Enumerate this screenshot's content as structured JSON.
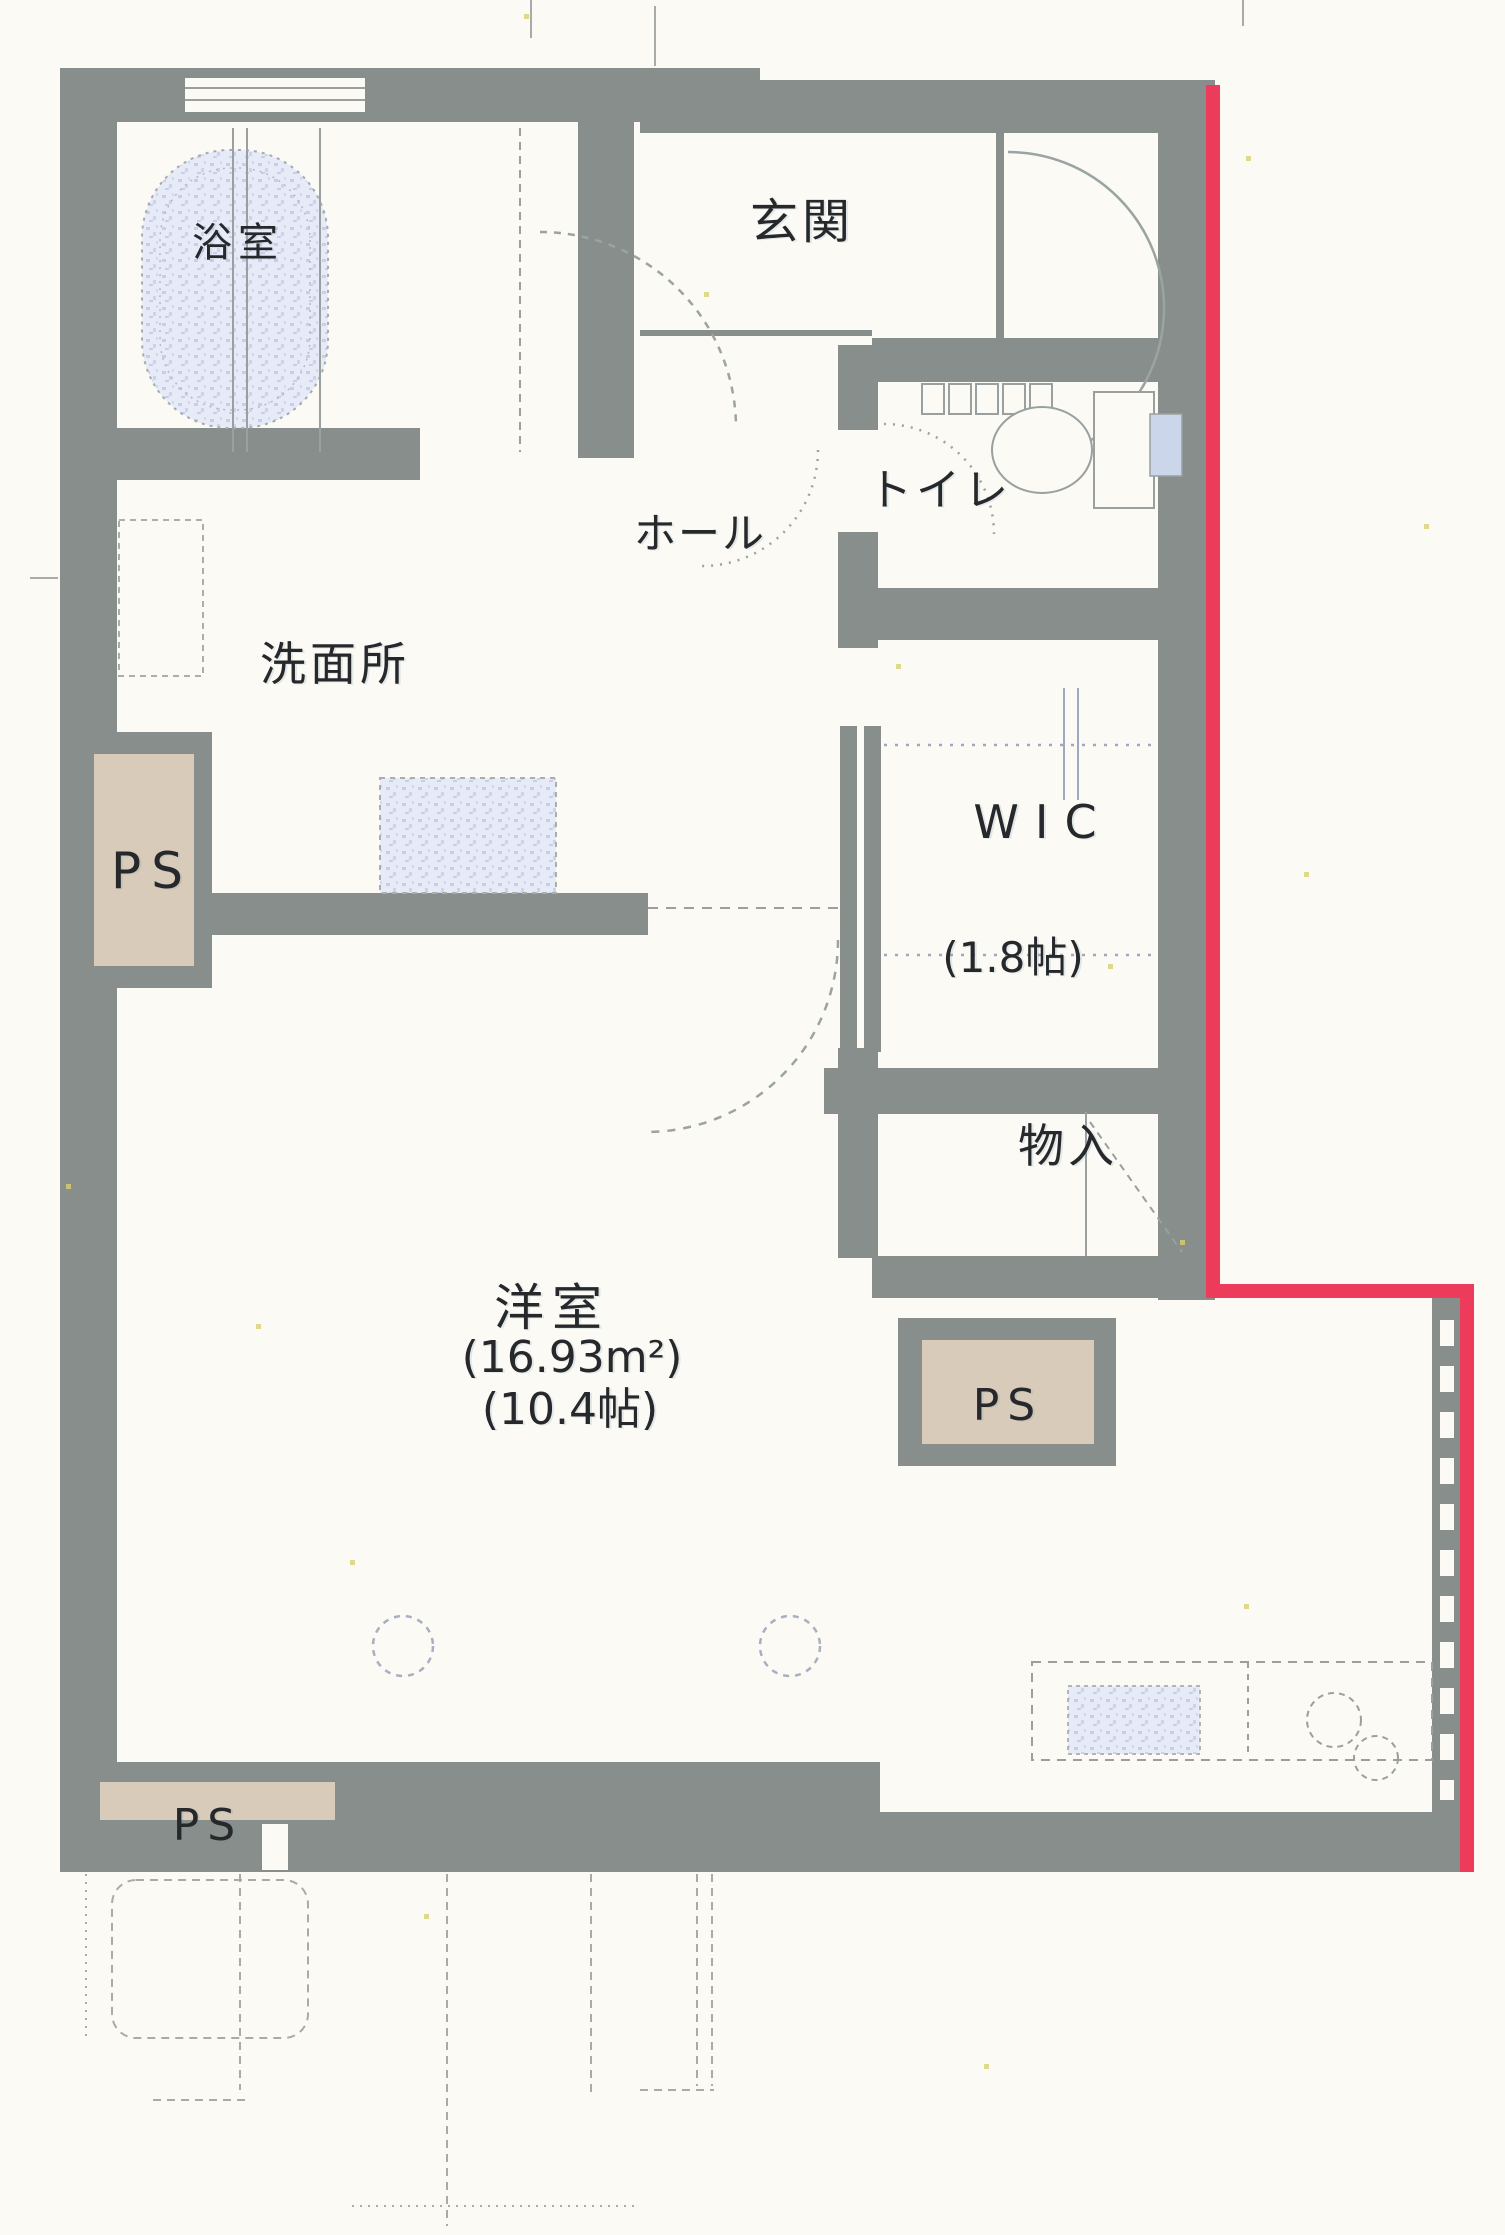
{
  "plan": {
    "type": "apartment-floorplan-scan",
    "rooms": {
      "bath": {
        "label": "浴室"
      },
      "entrance": {
        "label": "玄関"
      },
      "toilet": {
        "label": "トイレ"
      },
      "hall": {
        "label": "ホール"
      },
      "washroom": {
        "label": "洗面所"
      },
      "wic": {
        "label": "WIC",
        "size": "(1.8帖)"
      },
      "storage": {
        "label": "物入"
      },
      "main_room": {
        "label": "洋室",
        "area_sqm": "(16.93m²)",
        "area_tatami": "(10.4帖)"
      }
    },
    "pipe_spaces": {
      "left": "PS",
      "middle_right": "PS",
      "bottom_left": "PS"
    }
  },
  "colors": {
    "paper": "#fbfaf4",
    "wall": "#888e8c",
    "boundary_red": "#ed3b5c",
    "pipe_space_beige": "#d8cbb9",
    "fixture_blue": "#e7ebf7",
    "ink": "#26282c"
  }
}
